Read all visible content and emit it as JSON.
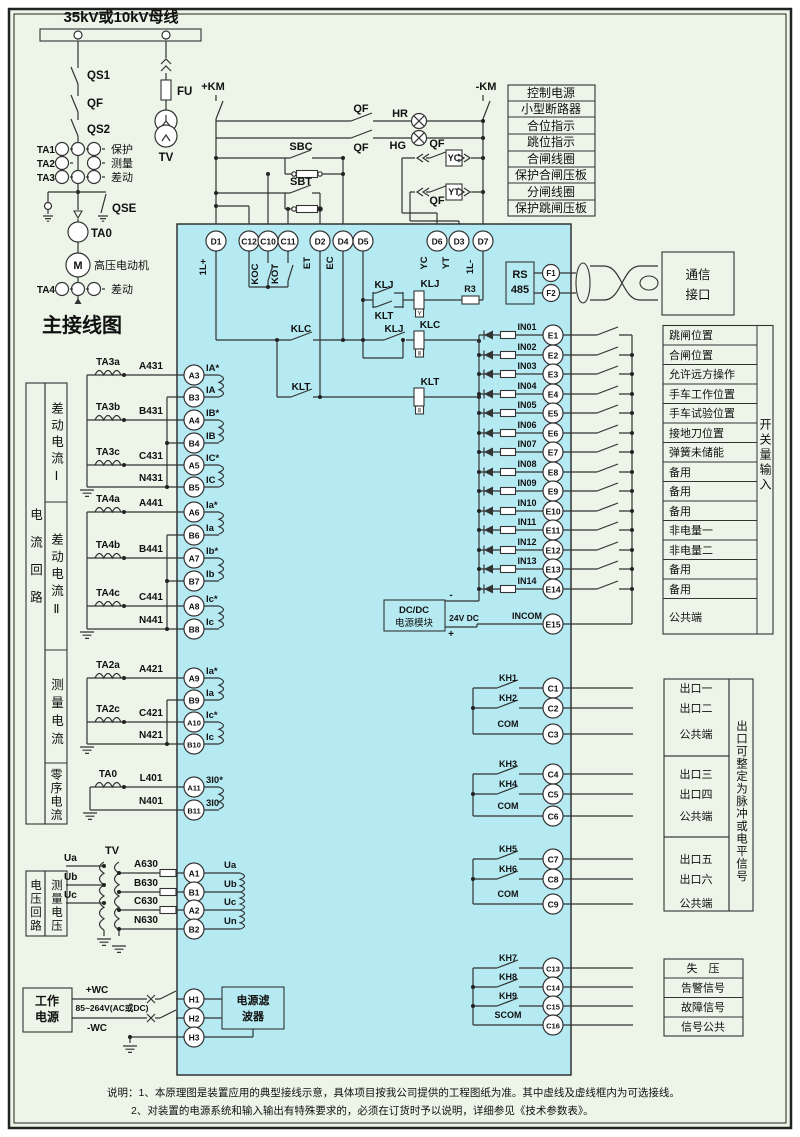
{
  "colors": {
    "bg": "#edf5e8",
    "device": "#b5eaf2",
    "line": "#333333"
  },
  "header": {
    "bus_title": "35kV或10kV母线",
    "main_title": "主接线图"
  },
  "primary": {
    "qs1": "QS1",
    "qf": "QF",
    "qs2": "QS2",
    "qse": "QSE",
    "fu": "FU",
    "tv": "TV",
    "ta0": "TA0",
    "motor_sym": "M",
    "motor": "高压电动机",
    "ct_rows": [
      {
        "id": "TA1",
        "use": "保护"
      },
      {
        "id": "TA2",
        "use": "测量"
      },
      {
        "id": "TA3",
        "use": "差动"
      }
    ],
    "ta4": {
      "id": "TA4",
      "use": "差动"
    }
  },
  "control": {
    "km_plus": "+KM",
    "km_minus": "-KM",
    "qf": "QF",
    "hr": "HR",
    "hg": "HG",
    "sbc": "SBC",
    "sbt": "SBT",
    "yc": "YC",
    "yt": "YT",
    "legend": [
      "控制电源",
      "小型断路器",
      "合位指示",
      "跳位指示",
      "合闸线圈",
      "保护合闸压板",
      "分闸线圈",
      "保护跳闸压板"
    ]
  },
  "device": {
    "top_terminals": [
      "D1",
      "C12",
      "C10",
      "C11",
      "D2",
      "D4",
      "D5",
      "D6",
      "D3",
      "D7"
    ],
    "top_sublabels": {
      "d1": "1L+",
      "koc": "KOC",
      "kot": "KOT",
      "et": "ET",
      "ec": "EC",
      "yc": "YC",
      "yt": "YT",
      "d7": "1L-"
    },
    "relays": {
      "klj": "KLJ",
      "klt": "KLT",
      "klc": "KLC",
      "r3": "R3",
      "glyph_y": "Y",
      "glyph_ii": "Ⅱ"
    },
    "rs485": {
      "l1": "RS",
      "l2": "485",
      "f1": "F1",
      "f2": "F2"
    },
    "dcdc": {
      "l1": "DC/DC",
      "l2": "电源模块",
      "volt": "24V DC",
      "minus": "-",
      "plus": "+"
    }
  },
  "comm": {
    "l1": "通信",
    "l2": "接口"
  },
  "inputs": {
    "rows": [
      {
        "sig": "IN01",
        "term": "E1",
        "label": "跳闸位置"
      },
      {
        "sig": "IN02",
        "term": "E2",
        "label": "合闸位置"
      },
      {
        "sig": "IN03",
        "term": "E3",
        "label": "允许远方操作"
      },
      {
        "sig": "IN04",
        "term": "E4",
        "label": "手车工作位置"
      },
      {
        "sig": "IN05",
        "term": "E5",
        "label": "手车试验位置"
      },
      {
        "sig": "IN06",
        "term": "E6",
        "label": "接地刀位置"
      },
      {
        "sig": "IN07",
        "term": "E7",
        "label": "弹簧未储能"
      },
      {
        "sig": "IN08",
        "term": "E8",
        "label": "备用"
      },
      {
        "sig": "IN09",
        "term": "E9",
        "label": "备用"
      },
      {
        "sig": "IN10",
        "term": "E10",
        "label": "备用"
      },
      {
        "sig": "IN11",
        "term": "E11",
        "label": "非电量一"
      },
      {
        "sig": "IN12",
        "term": "E12",
        "label": "非电量二"
      },
      {
        "sig": "IN13",
        "term": "E13",
        "label": "备用"
      },
      {
        "sig": "IN14",
        "term": "E14",
        "label": "备用"
      }
    ],
    "incom": {
      "sig": "INCOM",
      "term": "E15",
      "label": "公共端"
    },
    "side": "开关量输入"
  },
  "analog": {
    "sidebar": {
      "outer": "电流回路",
      "sections": [
        "差动电流Ⅰ",
        "差动电流Ⅱ",
        "测量电流",
        "零序电流"
      ]
    },
    "g1": {
      "r1": {
        "ct": "TA3a",
        "wire": "A431",
        "term": "A3",
        "sig": "IA*"
      },
      "r2": {
        "term": "B3",
        "sig": "IA"
      },
      "r3": {
        "ct": "TA3b",
        "wire": "B431",
        "term": "A4",
        "sig": "IB*"
      },
      "r4": {
        "term": "B4",
        "sig": "IB"
      },
      "r5": {
        "ct": "TA3c",
        "wire": "C431",
        "term": "A5",
        "sig": "IC*"
      },
      "r6": {
        "wire": "N431",
        "term": "B5",
        "sig": "IC"
      }
    },
    "g2": {
      "r1": {
        "ct": "TA4a",
        "wire": "A441",
        "term": "A6",
        "sig": "Ia*"
      },
      "r2": {
        "term": "B6",
        "sig": "Ia"
      },
      "r3": {
        "ct": "TA4b",
        "wire": "B441",
        "term": "A7",
        "sig": "Ib*"
      },
      "r4": {
        "term": "B7",
        "sig": "Ib"
      },
      "r5": {
        "ct": "TA4c",
        "wire": "C441",
        "term": "A8",
        "sig": "Ic*"
      },
      "r6": {
        "wire": "N441",
        "term": "B8",
        "sig": "Ic"
      }
    },
    "g3": {
      "r1": {
        "ct": "TA2a",
        "wire": "A421",
        "term": "A9",
        "sig": "Ia*"
      },
      "r2": {
        "term": "B9",
        "sig": "Ia"
      },
      "r3": {
        "ct": "TA2c",
        "wire": "C421",
        "term": "A10",
        "sig": "Ic*"
      },
      "r4": {
        "wire": "N421",
        "term": "B10",
        "sig": "Ic"
      }
    },
    "g4": {
      "r1": {
        "ct": "TA0",
        "wire": "L401",
        "term": "A11",
        "sig": "3I0*"
      },
      "r2": {
        "wire": "N401",
        "term": "B11",
        "sig": "3I0"
      }
    }
  },
  "voltage": {
    "sidebar_outer": "电压回路",
    "sidebar_inner": "测量电压",
    "tv": "TV",
    "phases": [
      "Ua",
      "Ub",
      "Uc"
    ],
    "rows": [
      {
        "wire": "A630",
        "term": "A1",
        "sig": "Ua"
      },
      {
        "wire": "B630",
        "term": "B1",
        "sig": "Ub"
      },
      {
        "wire": "C630",
        "term": "A2",
        "sig": "Uc"
      },
      {
        "wire": "N630",
        "term": "B2",
        "sig": "Un"
      }
    ]
  },
  "power": {
    "l1": "工作",
    "l2": "电源",
    "wc_plus": "+WC",
    "wc_minus": "-WC",
    "range": "85~264V(AC或DC)",
    "h1": "H1",
    "h2": "H2",
    "h3": "H3",
    "filter_l1": "电源滤",
    "filter_l2": "波器"
  },
  "outputs": {
    "g1": {
      "rows": [
        {
          "kh": "KH1",
          "term": "C1"
        },
        {
          "kh": "KH2",
          "term": "C2"
        },
        {
          "kh": "COM",
          "term": "C3"
        }
      ],
      "labels": [
        "出口一",
        "出口二",
        "公共端"
      ]
    },
    "g2": {
      "rows": [
        {
          "kh": "KH3",
          "term": "C4"
        },
        {
          "kh": "KH4",
          "term": "C5"
        },
        {
          "kh": "COM",
          "term": "C6"
        }
      ],
      "labels": [
        "出口三",
        "出口四",
        "公共端"
      ]
    },
    "g3": {
      "rows": [
        {
          "kh": "KH5",
          "term": "C7"
        },
        {
          "kh": "KH6",
          "term": "C8"
        },
        {
          "kh": "COM",
          "term": "C9"
        }
      ],
      "labels": [
        "出口五",
        "出口六",
        "公共端"
      ]
    },
    "side": "出口可整定为脉冲或电平信号",
    "sig": {
      "rows": [
        {
          "kh": "KH7",
          "term": "C13"
        },
        {
          "kh": "KH8",
          "term": "C14"
        },
        {
          "kh": "KH9",
          "term": "C15"
        },
        {
          "kh": "SCOM",
          "term": "C16"
        }
      ],
      "labels": [
        "失　压",
        "告警信号",
        "故障信号",
        "信号公共"
      ]
    }
  },
  "notes": {
    "l1": "说明：1、本原理图是装置应用的典型接线示意，具体项目按我公司提供的工程图纸为准。其中虚线及虚线框内为可选接线。",
    "l2": "2、对装置的电源系统和输入输出有特殊要求的，必须在订货时予以说明，详细参见《技术参数表》。"
  }
}
